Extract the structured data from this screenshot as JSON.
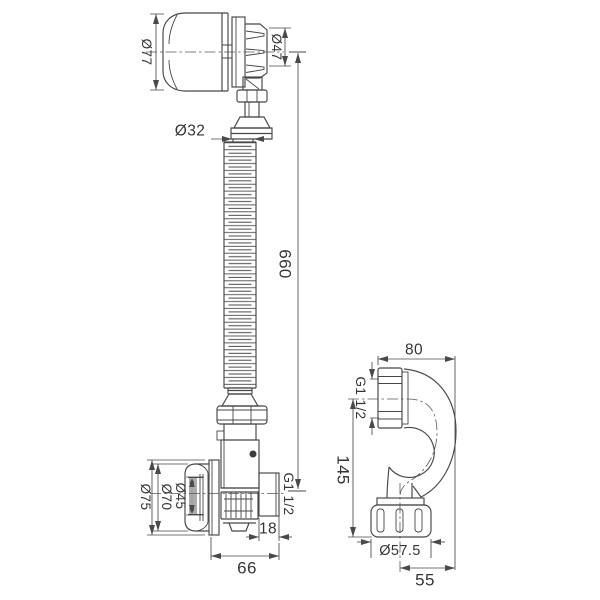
{
  "drawing": {
    "background": "#ffffff",
    "line_color": "#474747",
    "labels": {
      "head_knob_dia": "Ø77",
      "head_flange_dia": "Ø47",
      "pipe_dia": "Ø32",
      "pipe_length": "660",
      "overflow_plate_dia": "Ø75",
      "overflow_cap_dia": "Ø70",
      "overflow_inner_dia": "Ø45",
      "overflow_outlet_thread": "G1 1/2",
      "overflow_outlet_len": "18",
      "overflow_width": "66",
      "trap_width": "80",
      "trap_inlet_thread": "G1 1/2",
      "trap_height": "145",
      "trap_nut_dia": "Ø57.5",
      "trap_outlet_offset": "55"
    }
  }
}
